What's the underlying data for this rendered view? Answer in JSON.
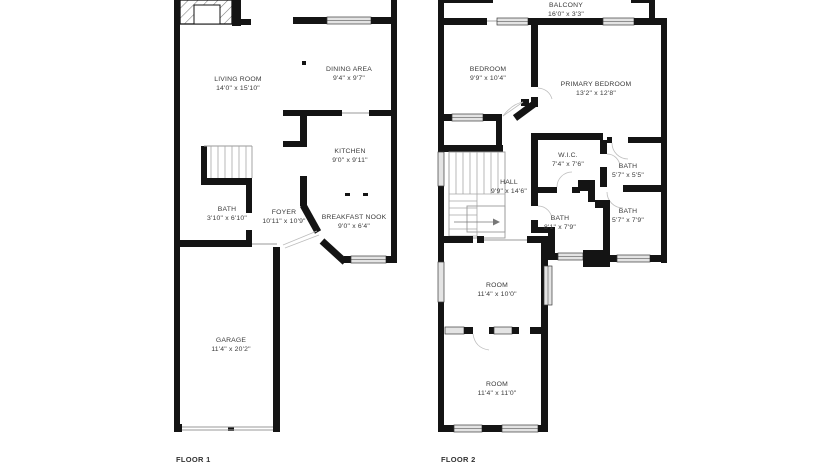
{
  "floors": [
    {
      "caption": "FLOOR 1",
      "rooms": [
        {
          "name": "LIVING ROOM",
          "dims": "14'0\" x 15'10\""
        },
        {
          "name": "DINING AREA",
          "dims": "9'4\" x 9'7\""
        },
        {
          "name": "KITCHEN",
          "dims": "9'0\" x 9'11\""
        },
        {
          "name": "BATH",
          "dims": "3'10\" x 6'10\""
        },
        {
          "name": "FOYER",
          "dims": "10'11\" x 10'9\""
        },
        {
          "name": "BREAKFAST NOOK",
          "dims": "9'0\" x 6'4\""
        },
        {
          "name": "GARAGE",
          "dims": "11'4\" x 20'2\""
        }
      ]
    },
    {
      "caption": "FLOOR 2",
      "rooms": [
        {
          "name": "BALCONY",
          "dims": "16'0\" x 3'3\""
        },
        {
          "name": "BEDROOM",
          "dims": "9'9\" x 10'4\""
        },
        {
          "name": "PRIMARY BEDROOM",
          "dims": "13'2\" x 12'8\""
        },
        {
          "name": "W.I.C.",
          "dims": "7'4\" x 7'6\""
        },
        {
          "name": "BATH",
          "dims": "5'7\" x 5'5\""
        },
        {
          "name": "HALL",
          "dims": "9'9\" x 14'6\""
        },
        {
          "name": "BATH",
          "dims": "8'1\" x 7'9\""
        },
        {
          "name": "BATH",
          "dims": "5'7\" x 7'9\""
        },
        {
          "name": "ROOM",
          "dims": "11'4\" x 10'0\""
        },
        {
          "name": "ROOM",
          "dims": "11'4\" x 11'0\""
        }
      ]
    }
  ],
  "colors": {
    "wall": "#141414",
    "window_fill": "#e4e4e4",
    "text": "#3a3a3a"
  }
}
